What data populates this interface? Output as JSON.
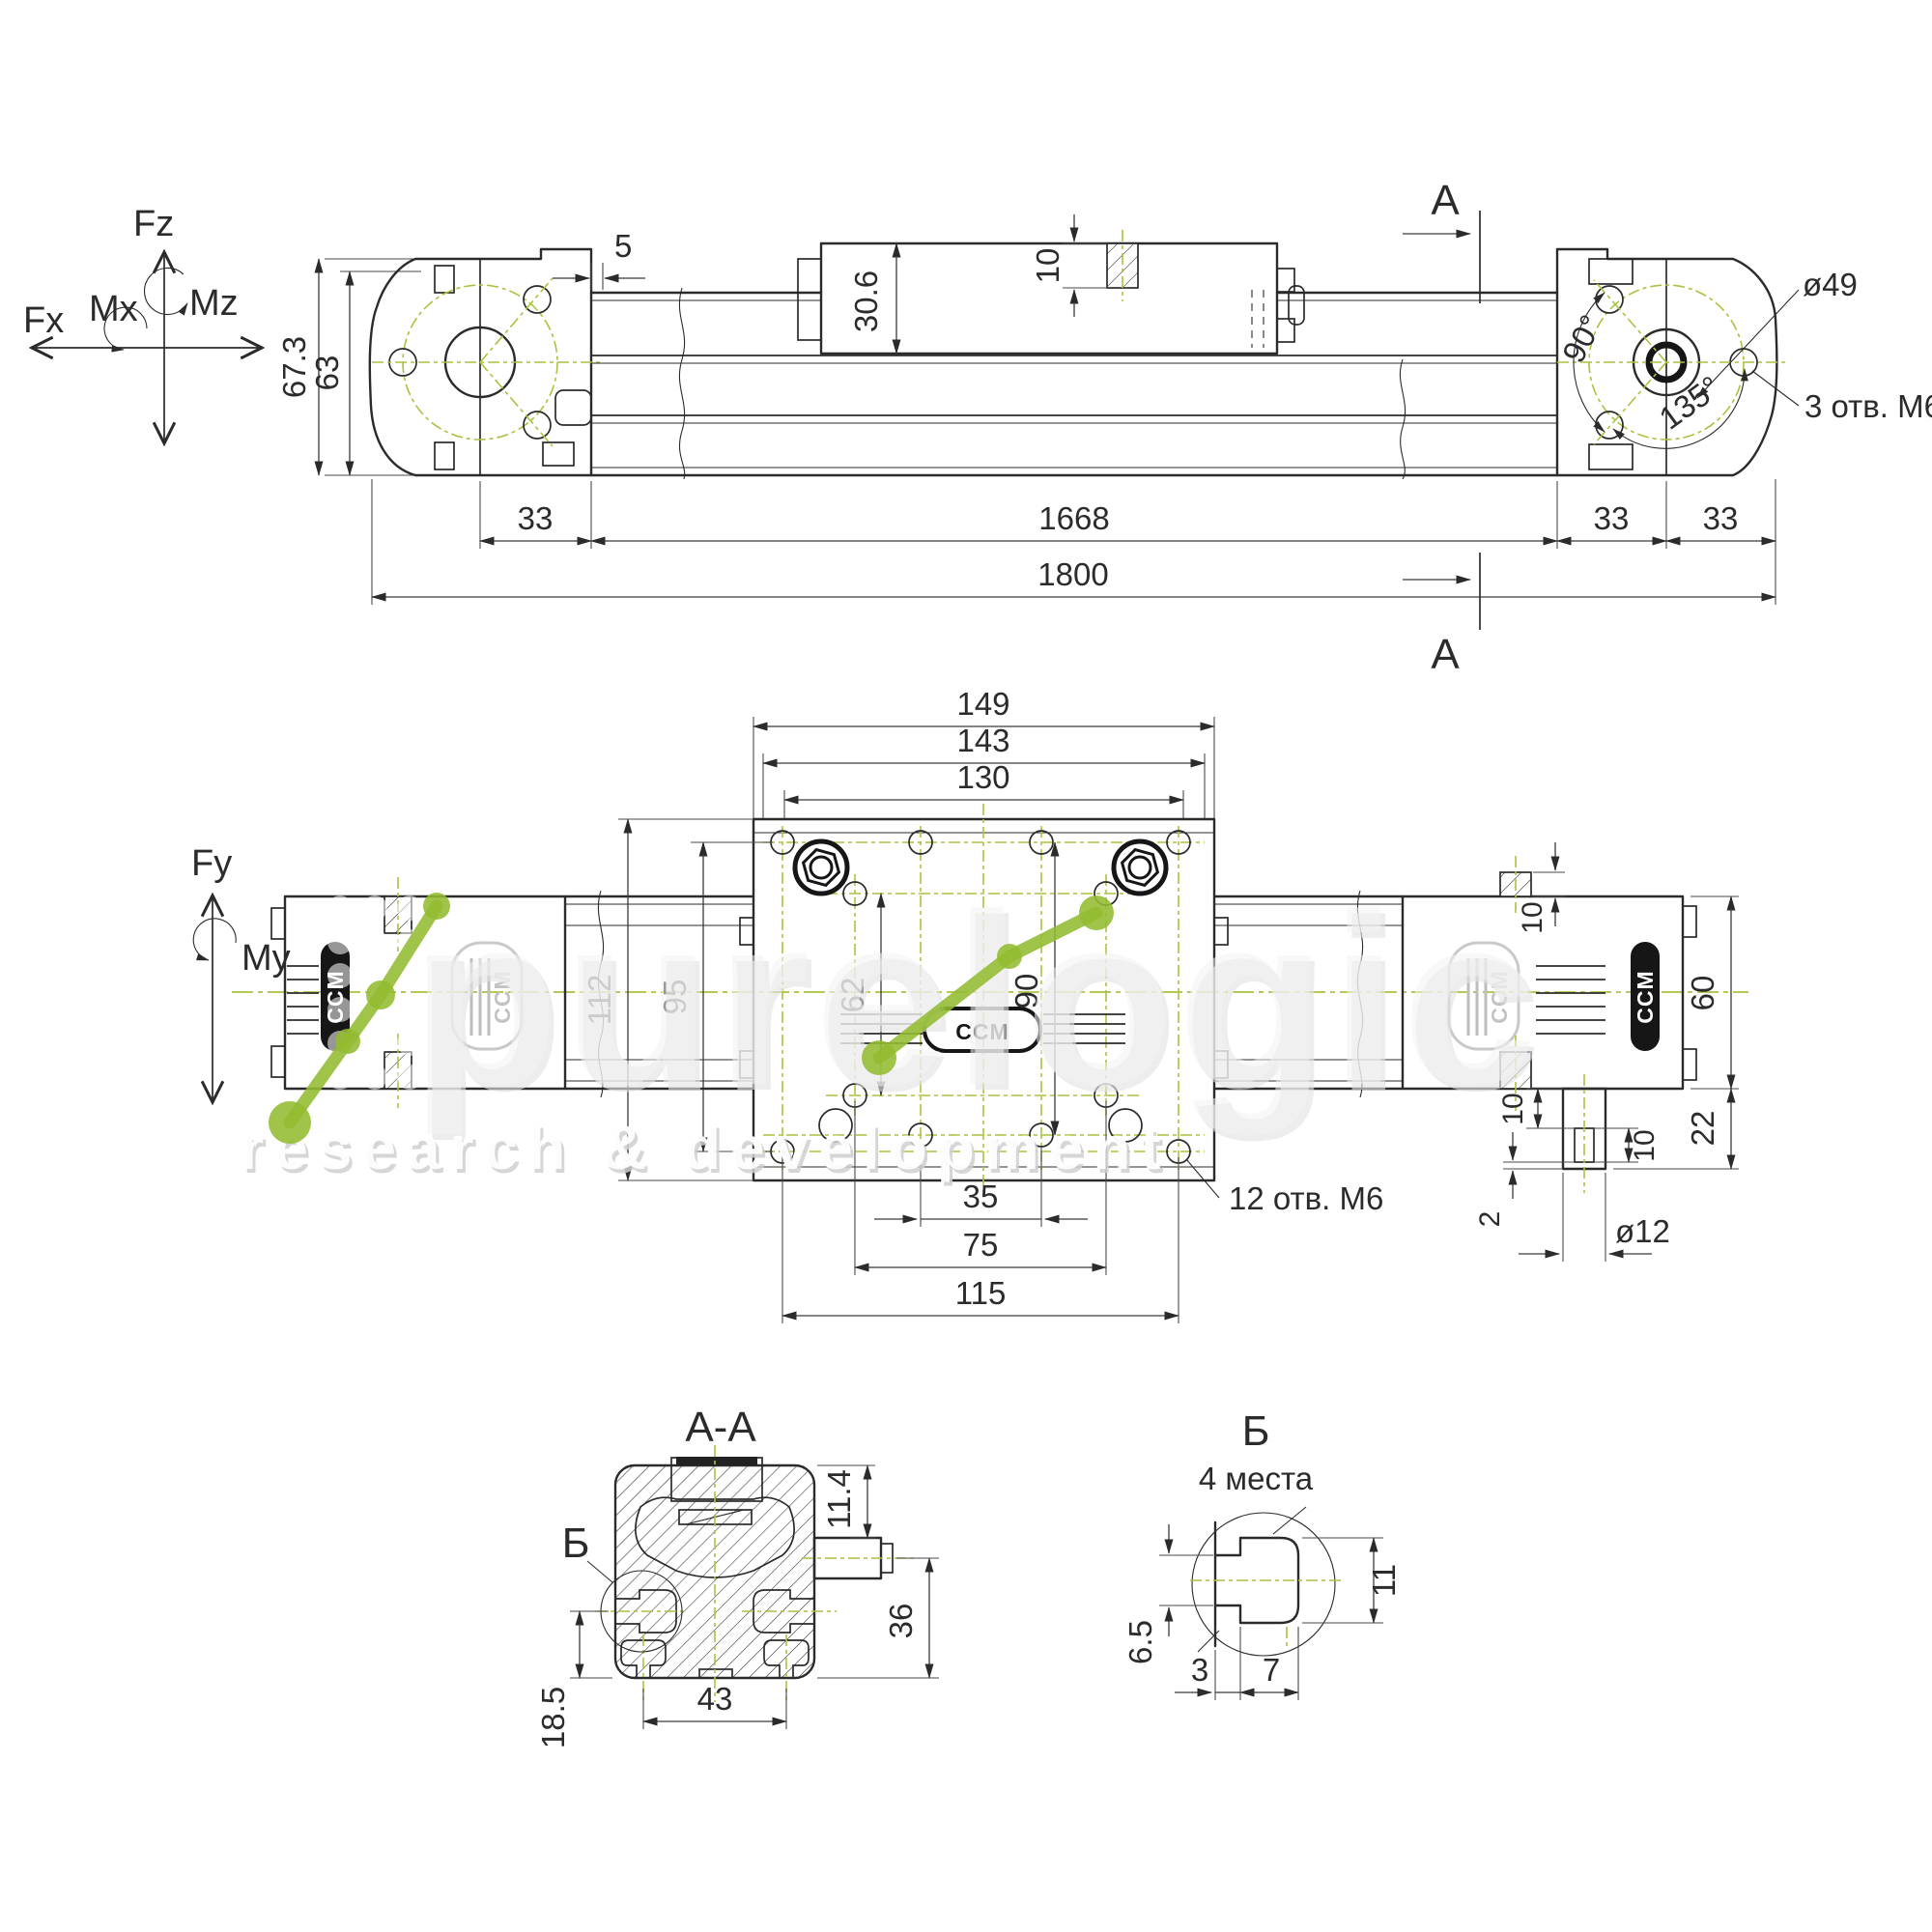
{
  "colors": {
    "line": "#2b2b2b",
    "centerline_green": "#a7c43e",
    "accent_green": "#93bc31",
    "watermark_gray": "#e9e9e9"
  },
  "axes": {
    "fz": "Fz",
    "mz": "Mz",
    "mx": "Mx",
    "fx": "Fx",
    "fy": "Fy",
    "my": "My"
  },
  "top_view": {
    "dims": {
      "height_outer": "67.3",
      "height_inner": "63",
      "step": "5",
      "carriage_height": "30.6",
      "hole_depth": "10",
      "pitch_left": "33",
      "body_length": "1668",
      "pitch_right_inner": "33",
      "pitch_right_outer": "33",
      "overall_length": "1800"
    },
    "labels": {
      "bolt_circle_dia": "ø49",
      "angle_a": "90°",
      "angle_b": "135°",
      "holes_note": "3 отв. М6",
      "section_mark": "A"
    }
  },
  "plan_view": {
    "dims": {
      "plate_w_outer": "149",
      "plate_w_mid": "143",
      "plate_w_inner": "130",
      "plate_h_outer": "112",
      "plate_h_inner": "95",
      "hole_rows_inner": "62",
      "hole_rows_outer": "90",
      "rail_height": "60",
      "boss_step": "10",
      "flange_height": "22",
      "shaft_step": "10",
      "key_length": "10",
      "tip_step": "2",
      "shaft_dia": "ø12",
      "hole_cols_inner": "35",
      "hole_cols_mid": "75",
      "hole_cols_outer": "115"
    },
    "labels": {
      "holes_note": "12 отв. М6"
    }
  },
  "section_aa": {
    "title": "A-A",
    "detail_mark": "Б",
    "dims": {
      "slot_offset": "11.4",
      "shaft_height": "36",
      "slot_spacing": "43",
      "edge_slot_offset": "18.5"
    }
  },
  "detail_b": {
    "title": "Б",
    "subtitle": "4 места",
    "dims": {
      "neck_height": "6.5",
      "pocket_height": "11",
      "neck_depth": "3",
      "pocket_depth": "7"
    }
  },
  "brand": {
    "logo": "CCM"
  },
  "watermark": {
    "brand": "purelogic",
    "tagline": "research & development"
  }
}
